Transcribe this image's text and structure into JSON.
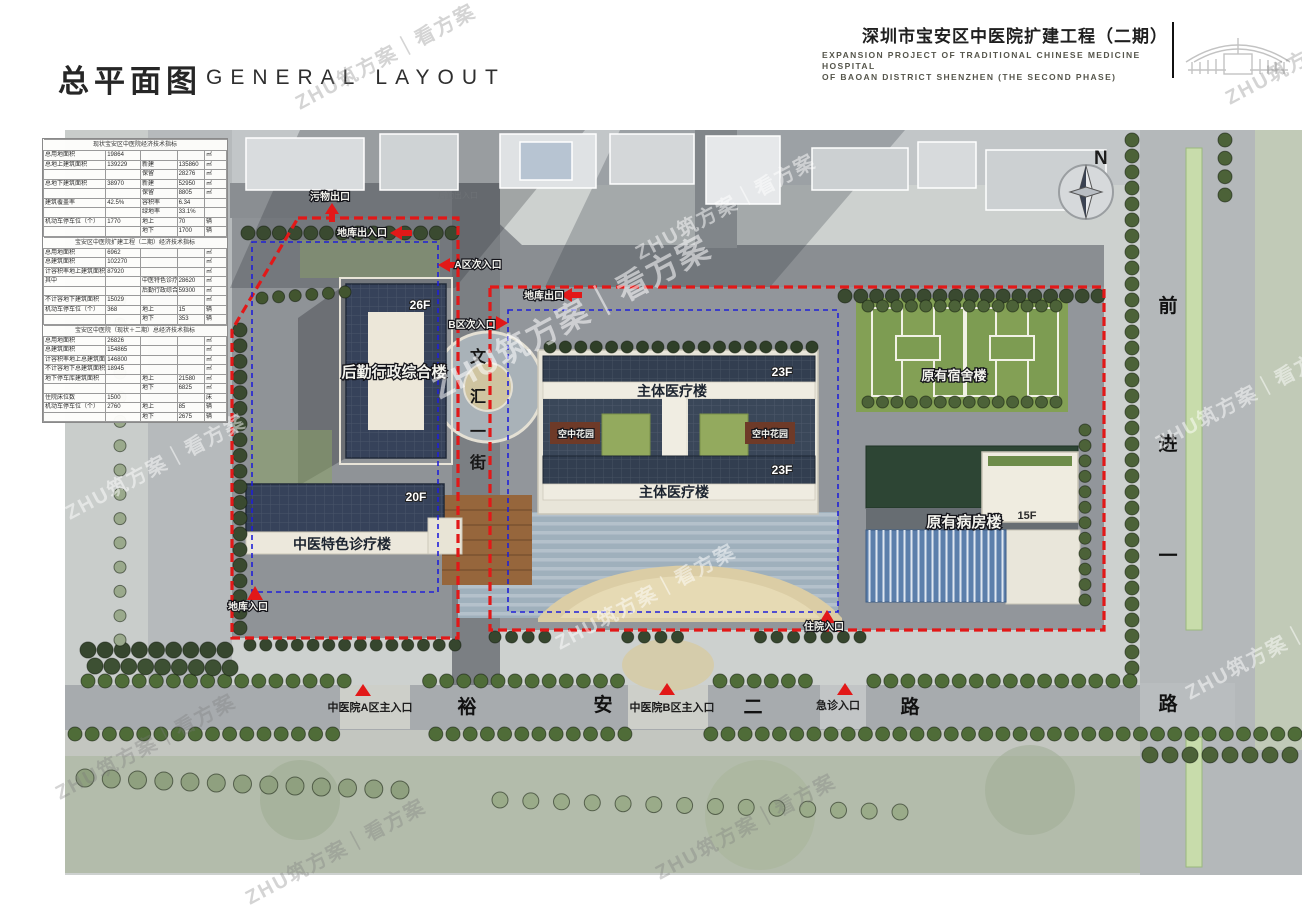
{
  "header": {
    "title_cn": "深圳市宝安区中医院扩建工程（二期）",
    "title_en1": "Expansion project of traditional Chinese medicine Hospital",
    "title_en2": "of Baoan District Shenzhen (the second phase)"
  },
  "title": {
    "cn": "总平面图",
    "en": "GENERAL LAYOUT"
  },
  "compass": {
    "label": "N"
  },
  "watermark": {
    "text": "ZHU筑方案｜看方案"
  },
  "table": {
    "sections": [
      {
        "header": "现状宝安区中医院经济技术指标",
        "rows": [
          [
            "总用地面积",
            "19864",
            "",
            "",
            "㎡"
          ],
          [
            "总地上建筑面积",
            "139229",
            "新建",
            "135860",
            "㎡"
          ],
          [
            "",
            "",
            "保留",
            "28276",
            "㎡"
          ],
          [
            "总地下建筑面积",
            "38970",
            "新建",
            "52950",
            "㎡"
          ],
          [
            "",
            "",
            "保留",
            "8805",
            "㎡"
          ],
          [
            "建筑覆盖率",
            "42.5%",
            "容积率",
            "6.34",
            ""
          ],
          [
            "",
            "",
            "绿地率",
            "33.1%",
            ""
          ],
          [
            "机动车停车位（个）",
            "1770",
            "地上",
            "70",
            "辆"
          ],
          [
            "",
            "",
            "地下",
            "1700",
            "辆"
          ]
        ]
      },
      {
        "header": "宝安区中医院扩建工程（二期）经济技术指标",
        "rows": [
          [
            "总用地面积",
            "6962",
            "",
            "",
            "㎡"
          ],
          [
            "总建筑面积",
            "102270",
            "",
            "",
            "㎡"
          ],
          [
            "计容积率地上建筑面积",
            "87920",
            "",
            "",
            "㎡"
          ],
          [
            "其中",
            "",
            "中医特色诊疗楼",
            "28620",
            "㎡"
          ],
          [
            "",
            "",
            "后勤行政综合楼",
            "59300",
            "㎡"
          ],
          [
            "不计容地下建筑面积",
            "15029",
            "",
            "",
            "㎡"
          ],
          [
            "机动车停车位（个）",
            "368",
            "地上",
            "15",
            "辆"
          ],
          [
            "",
            "",
            "地下",
            "353",
            "辆"
          ]
        ]
      },
      {
        "header": "宝安区中医院（现状＋二期）总经济技术指标",
        "rows": [
          [
            "总用地面积",
            "26826",
            "",
            "",
            "㎡"
          ],
          [
            "总建筑面积",
            "154865",
            "",
            "",
            "㎡"
          ],
          [
            "计容积率地上总建筑面积",
            "146800",
            "",
            "",
            "㎡"
          ],
          [
            "不计容地下总建筑面积",
            "18945",
            "",
            "",
            "㎡"
          ],
          [
            "地下停车库建筑面积",
            "",
            "地上",
            "21580",
            "㎡"
          ],
          [
            "",
            "",
            "地下",
            "6825",
            "㎡"
          ],
          [
            "住院床位数",
            "1500",
            "",
            "",
            "床"
          ],
          [
            "机动车停车位（个）",
            "2760",
            "地上",
            "85",
            "辆"
          ],
          [
            "",
            "",
            "地下",
            "2675",
            "辆"
          ]
        ]
      }
    ]
  },
  "plan": {
    "buildings": {
      "logistics_admin": {
        "name": "后勤行政综合楼",
        "floors": "26F"
      },
      "tcm_clinic": {
        "name": "中医特色诊疗楼",
        "floors": "20F"
      },
      "main_medical": {
        "name": "主体医疗楼",
        "floors": "23F"
      },
      "sky_garden": "空中花园",
      "dorm": {
        "name": "原有宿舍楼"
      },
      "ward": {
        "name": "原有病房楼",
        "floors": "15F"
      }
    },
    "entrances": {
      "waste_exit": "污物出口",
      "logistics_entrance": "后勤出入口",
      "garage_gate": "地库出入口",
      "a_secondary": "A区次入口",
      "garage_exit": "地库出口",
      "b_secondary": "B区次入口",
      "garage_entry": "地库入口",
      "inpatient": "住院入口",
      "a_main": "中医院A区主入口",
      "b_main": "中医院B区主入口",
      "emergency": "急诊入口"
    },
    "streets": {
      "wenhui": [
        "文",
        "汇",
        "一",
        "街"
      ],
      "yuan": [
        "裕",
        "安",
        "二",
        "路"
      ],
      "qianjin": [
        "前",
        "进",
        "一",
        "路"
      ]
    }
  }
}
